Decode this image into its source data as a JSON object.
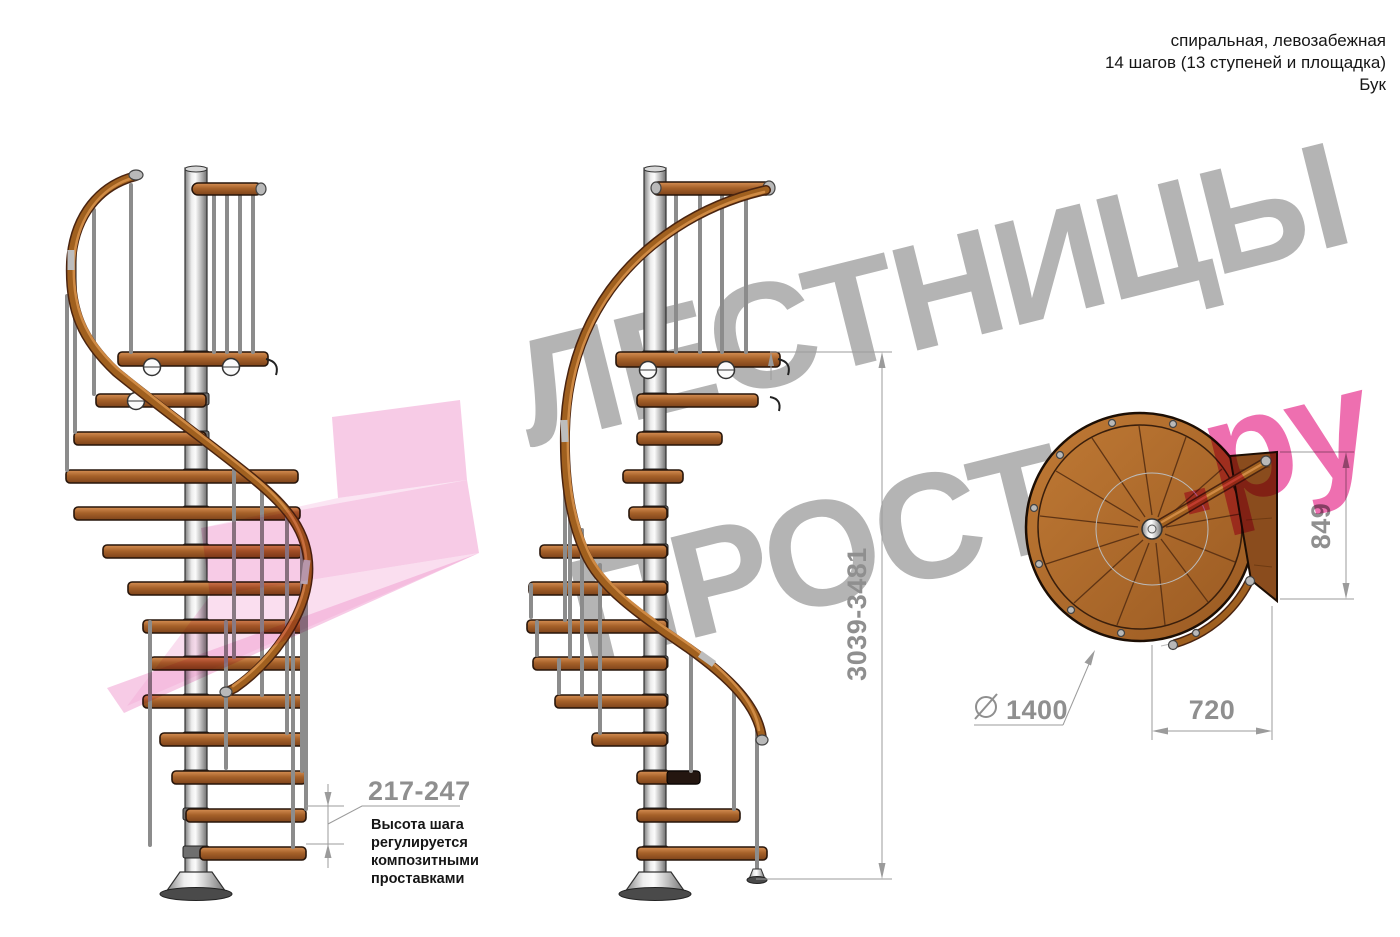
{
  "header": {
    "line1": "спиральная, левозабежная",
    "line2": "14 шагов (13 ступеней и площадка)",
    "line3": "Бук"
  },
  "watermark": {
    "line1": "ЛЕСТНИЦЫ",
    "line2": "ПРОСТО",
    "suffix": ".ру",
    "gray_color": "#b4b4b4",
    "pink_color": "#ee6fb0"
  },
  "dimensions": {
    "total_height": "3039-3481",
    "step_height": "217-247",
    "plan_depth": "849",
    "platform_width": "720",
    "diameter": "1400",
    "diameter_symbol": "circle-slash",
    "step_note": [
      "Высота шага",
      "регулируется",
      "композитными",
      "проставками"
    ]
  },
  "colors": {
    "wood": "#a8632b",
    "wood_dark": "#8a4c1d",
    "pole_metal": "#d9d9d9",
    "dimension_gray": "#8f8f8f",
    "watermark_pink_arrow": "#f2a9d6"
  }
}
